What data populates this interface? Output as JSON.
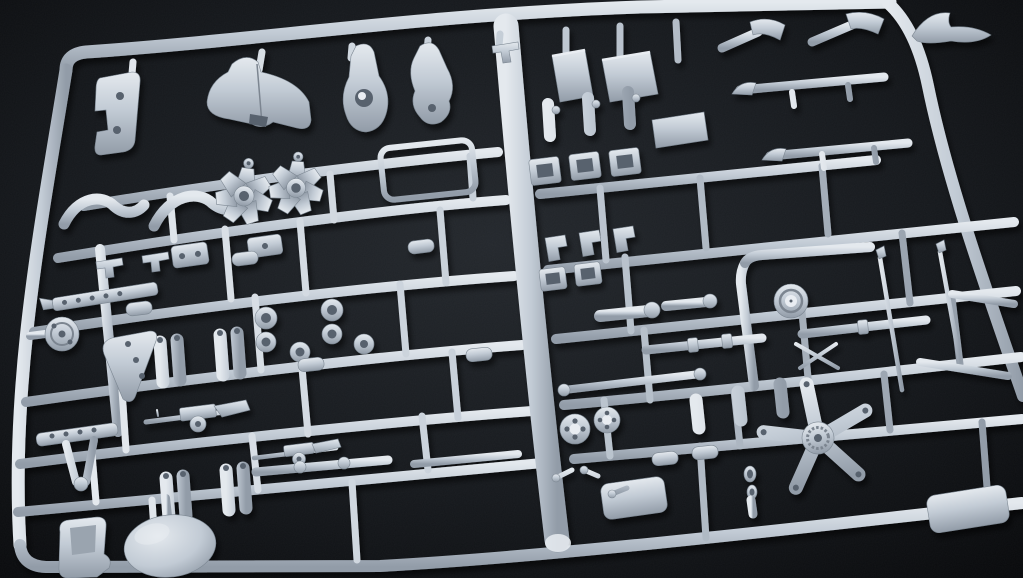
{
  "scene": {
    "description": "Close-up photograph of an unassembled plastic scale-model kit sprue: light grey styrene parts attached to a rectangular runner frame, lit from the upper left, on a black background",
    "visible_text": "none",
    "lighting": "single soft key light from upper-left with strong falloff into a dark background",
    "camera_angle": "oblique; sprue tilted, rising slightly toward the right"
  },
  "colors": {
    "background_deep": "#07080a",
    "background_mid": "#15181c",
    "background_glow": "#23272c",
    "plastic_light": "#e4e9ee",
    "plastic_base": "#c2cbd5",
    "plastic_dark": "#929ca8",
    "plastic_deep": "#59626e"
  },
  "sprue": {
    "material": "injection-molded polystyrene",
    "frame_shape": "rounded rectangle",
    "horizontal_runners": 6,
    "vertical_runners": 3,
    "parts_catalog": [
      {
        "name": "engine cowling",
        "qty": 1
      },
      {
        "name": "teardrop drop tank",
        "qty": 1
      },
      {
        "name": "streamlined fairing",
        "qty": 1
      },
      {
        "name": "radial engine cylinder bank",
        "qty": 2
      },
      {
        "name": "curved exhaust pipe",
        "qty": 2
      },
      {
        "name": "windscreen frame",
        "qty": 1
      },
      {
        "name": "box-shaped seat or tank",
        "qty": 2
      },
      {
        "name": "bulkhead plate",
        "qty": 1
      },
      {
        "name": "hooked wing strut",
        "qty": 2
      },
      {
        "name": "long strut bar",
        "qty": 2
      },
      {
        "name": "propeller blade",
        "qty": 1
      },
      {
        "name": "machine gun with ammunition drum",
        "qty": 2
      },
      {
        "name": "twin-cylinder landing gear oleo",
        "qty": 4
      },
      {
        "name": "spoked wheel",
        "qty": 2
      },
      {
        "name": "five-spoke wheel hub",
        "qty": 1
      },
      {
        "name": "large ovoid tire",
        "qty": 1
      },
      {
        "name": "bucket seat",
        "qty": 1
      },
      {
        "name": "landing gear door",
        "qty": 1
      },
      {
        "name": "perforated mounting strip",
        "qty": 2
      },
      {
        "name": "antenna or pitot rod",
        "qty": 2
      },
      {
        "name": "tow chain shackle",
        "qty": 1
      },
      {
        "name": "access panel",
        "qty": 2
      },
      {
        "name": "filler cap boss",
        "qty": 1
      },
      {
        "name": "square frame section",
        "qty": 5
      },
      {
        "name": "assorted small brackets, rings, rods and couplings",
        "qty": "30+"
      }
    ]
  }
}
